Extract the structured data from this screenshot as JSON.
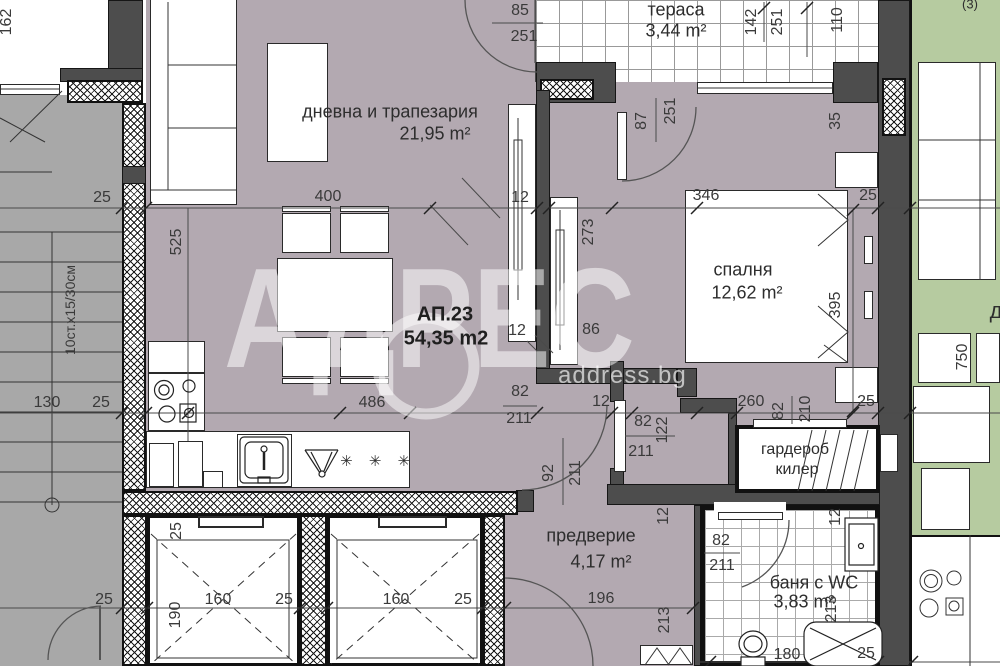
{
  "watermark": {
    "brand": "АДРЕС",
    "site": "address.bg"
  },
  "apartment": {
    "number": "АП.23",
    "total_area": "54,35 m2"
  },
  "rooms": {
    "living": {
      "name": "дневна и трапезария",
      "area": "21,95 m²"
    },
    "terrace": {
      "name": "тераса",
      "area": "3,44 m²"
    },
    "bedroom": {
      "name": "спалня",
      "area": "12,62 m²"
    },
    "hallway": {
      "name": "предверие",
      "area": "4,17 m²"
    },
    "bathroom": {
      "name": "баня с WC",
      "area": "3,83 m²"
    },
    "wardrobe": {
      "line1": "гардероб",
      "line2": "килер"
    }
  },
  "kitchen": {
    "stars": "✳ ✳ ✳"
  },
  "adjacent": {
    "room_initial": "д",
    "corner_mark": "(3)"
  },
  "dims": [
    {
      "t": "162",
      "x": 7,
      "y": 22,
      "r": -90
    },
    {
      "t": "25",
      "x": 102,
      "y": 198,
      "r": 0
    },
    {
      "t": "400",
      "x": 328,
      "y": 197,
      "r": 0
    },
    {
      "t": "85",
      "x": 520,
      "y": 11,
      "r": 0
    },
    {
      "t": "251",
      "x": 524,
      "y": 37,
      "r": 0
    },
    {
      "t": "142",
      "x": 752,
      "y": 22,
      "r": -90
    },
    {
      "t": "251",
      "x": 778,
      "y": 22,
      "r": -90
    },
    {
      "t": "110",
      "x": 838,
      "y": 20,
      "r": -90
    },
    {
      "t": "12",
      "x": 520,
      "y": 198,
      "r": 0
    },
    {
      "t": "346",
      "x": 706,
      "y": 196,
      "r": 0
    },
    {
      "t": "25",
      "x": 868,
      "y": 196,
      "r": 0
    },
    {
      "t": "87",
      "x": 642,
      "y": 121,
      "r": -90
    },
    {
      "t": "251",
      "x": 671,
      "y": 111,
      "r": -90
    },
    {
      "t": "35",
      "x": 836,
      "y": 121,
      "r": -90
    },
    {
      "t": "525",
      "x": 177,
      "y": 242,
      "r": -90
    },
    {
      "t": "10ст.х15/30см",
      "x": 70,
      "y": 310,
      "r": -90,
      "cls": "small"
    },
    {
      "t": "273",
      "x": 589,
      "y": 232,
      "r": -90
    },
    {
      "t": "395",
      "x": 836,
      "y": 305,
      "r": -90
    },
    {
      "t": "12",
      "x": 517,
      "y": 331,
      "r": 0
    },
    {
      "t": "86",
      "x": 591,
      "y": 330,
      "r": 0
    },
    {
      "t": "130",
      "x": 47,
      "y": 403,
      "r": 0
    },
    {
      "t": "25",
      "x": 101,
      "y": 403,
      "r": 0
    },
    {
      "t": "486",
      "x": 372,
      "y": 403,
      "r": 0
    },
    {
      "t": "12",
      "x": 601,
      "y": 402,
      "r": 0
    },
    {
      "t": "82",
      "x": 520,
      "y": 392,
      "r": 0
    },
    {
      "t": "211",
      "x": 519,
      "y": 419,
      "r": 0
    },
    {
      "t": "82",
      "x": 643,
      "y": 422,
      "r": 0
    },
    {
      "t": "122",
      "x": 663,
      "y": 430,
      "r": -90
    },
    {
      "t": "211",
      "x": 641,
      "y": 452,
      "r": 0
    },
    {
      "t": "260",
      "x": 751,
      "y": 402,
      "r": 0
    },
    {
      "t": "82",
      "x": 779,
      "y": 411,
      "r": -90
    },
    {
      "t": "210",
      "x": 806,
      "y": 409,
      "r": -90
    },
    {
      "t": "25",
      "x": 866,
      "y": 402,
      "r": 0
    },
    {
      "t": "92",
      "x": 549,
      "y": 473,
      "r": -90
    },
    {
      "t": "211",
      "x": 576,
      "y": 473,
      "r": -90
    },
    {
      "t": "12",
      "x": 664,
      "y": 516,
      "r": -90
    },
    {
      "t": "12",
      "x": 836,
      "y": 517,
      "r": -90
    },
    {
      "t": "82",
      "x": 721,
      "y": 541,
      "r": 0
    },
    {
      "t": "211",
      "x": 722,
      "y": 566,
      "r": 0
    },
    {
      "t": "25",
      "x": 177,
      "y": 531,
      "r": -90
    },
    {
      "t": "190",
      "x": 176,
      "y": 615,
      "r": -90
    },
    {
      "t": "160",
      "x": 218,
      "y": 600,
      "r": 0
    },
    {
      "t": "25",
      "x": 284,
      "y": 600,
      "r": 0
    },
    {
      "t": "160",
      "x": 396,
      "y": 600,
      "r": 0
    },
    {
      "t": "25",
      "x": 463,
      "y": 600,
      "r": 0
    },
    {
      "t": "25",
      "x": 104,
      "y": 600,
      "r": 0
    },
    {
      "t": "196",
      "x": 601,
      "y": 599,
      "r": 0
    },
    {
      "t": "213",
      "x": 665,
      "y": 620,
      "r": -90
    },
    {
      "t": "213",
      "x": 832,
      "y": 609,
      "r": -90
    },
    {
      "t": "180",
      "x": 787,
      "y": 655,
      "r": 0
    },
    {
      "t": "25",
      "x": 866,
      "y": 654,
      "r": 0
    },
    {
      "t": "750",
      "x": 963,
      "y": 357,
      "r": -90
    }
  ]
}
